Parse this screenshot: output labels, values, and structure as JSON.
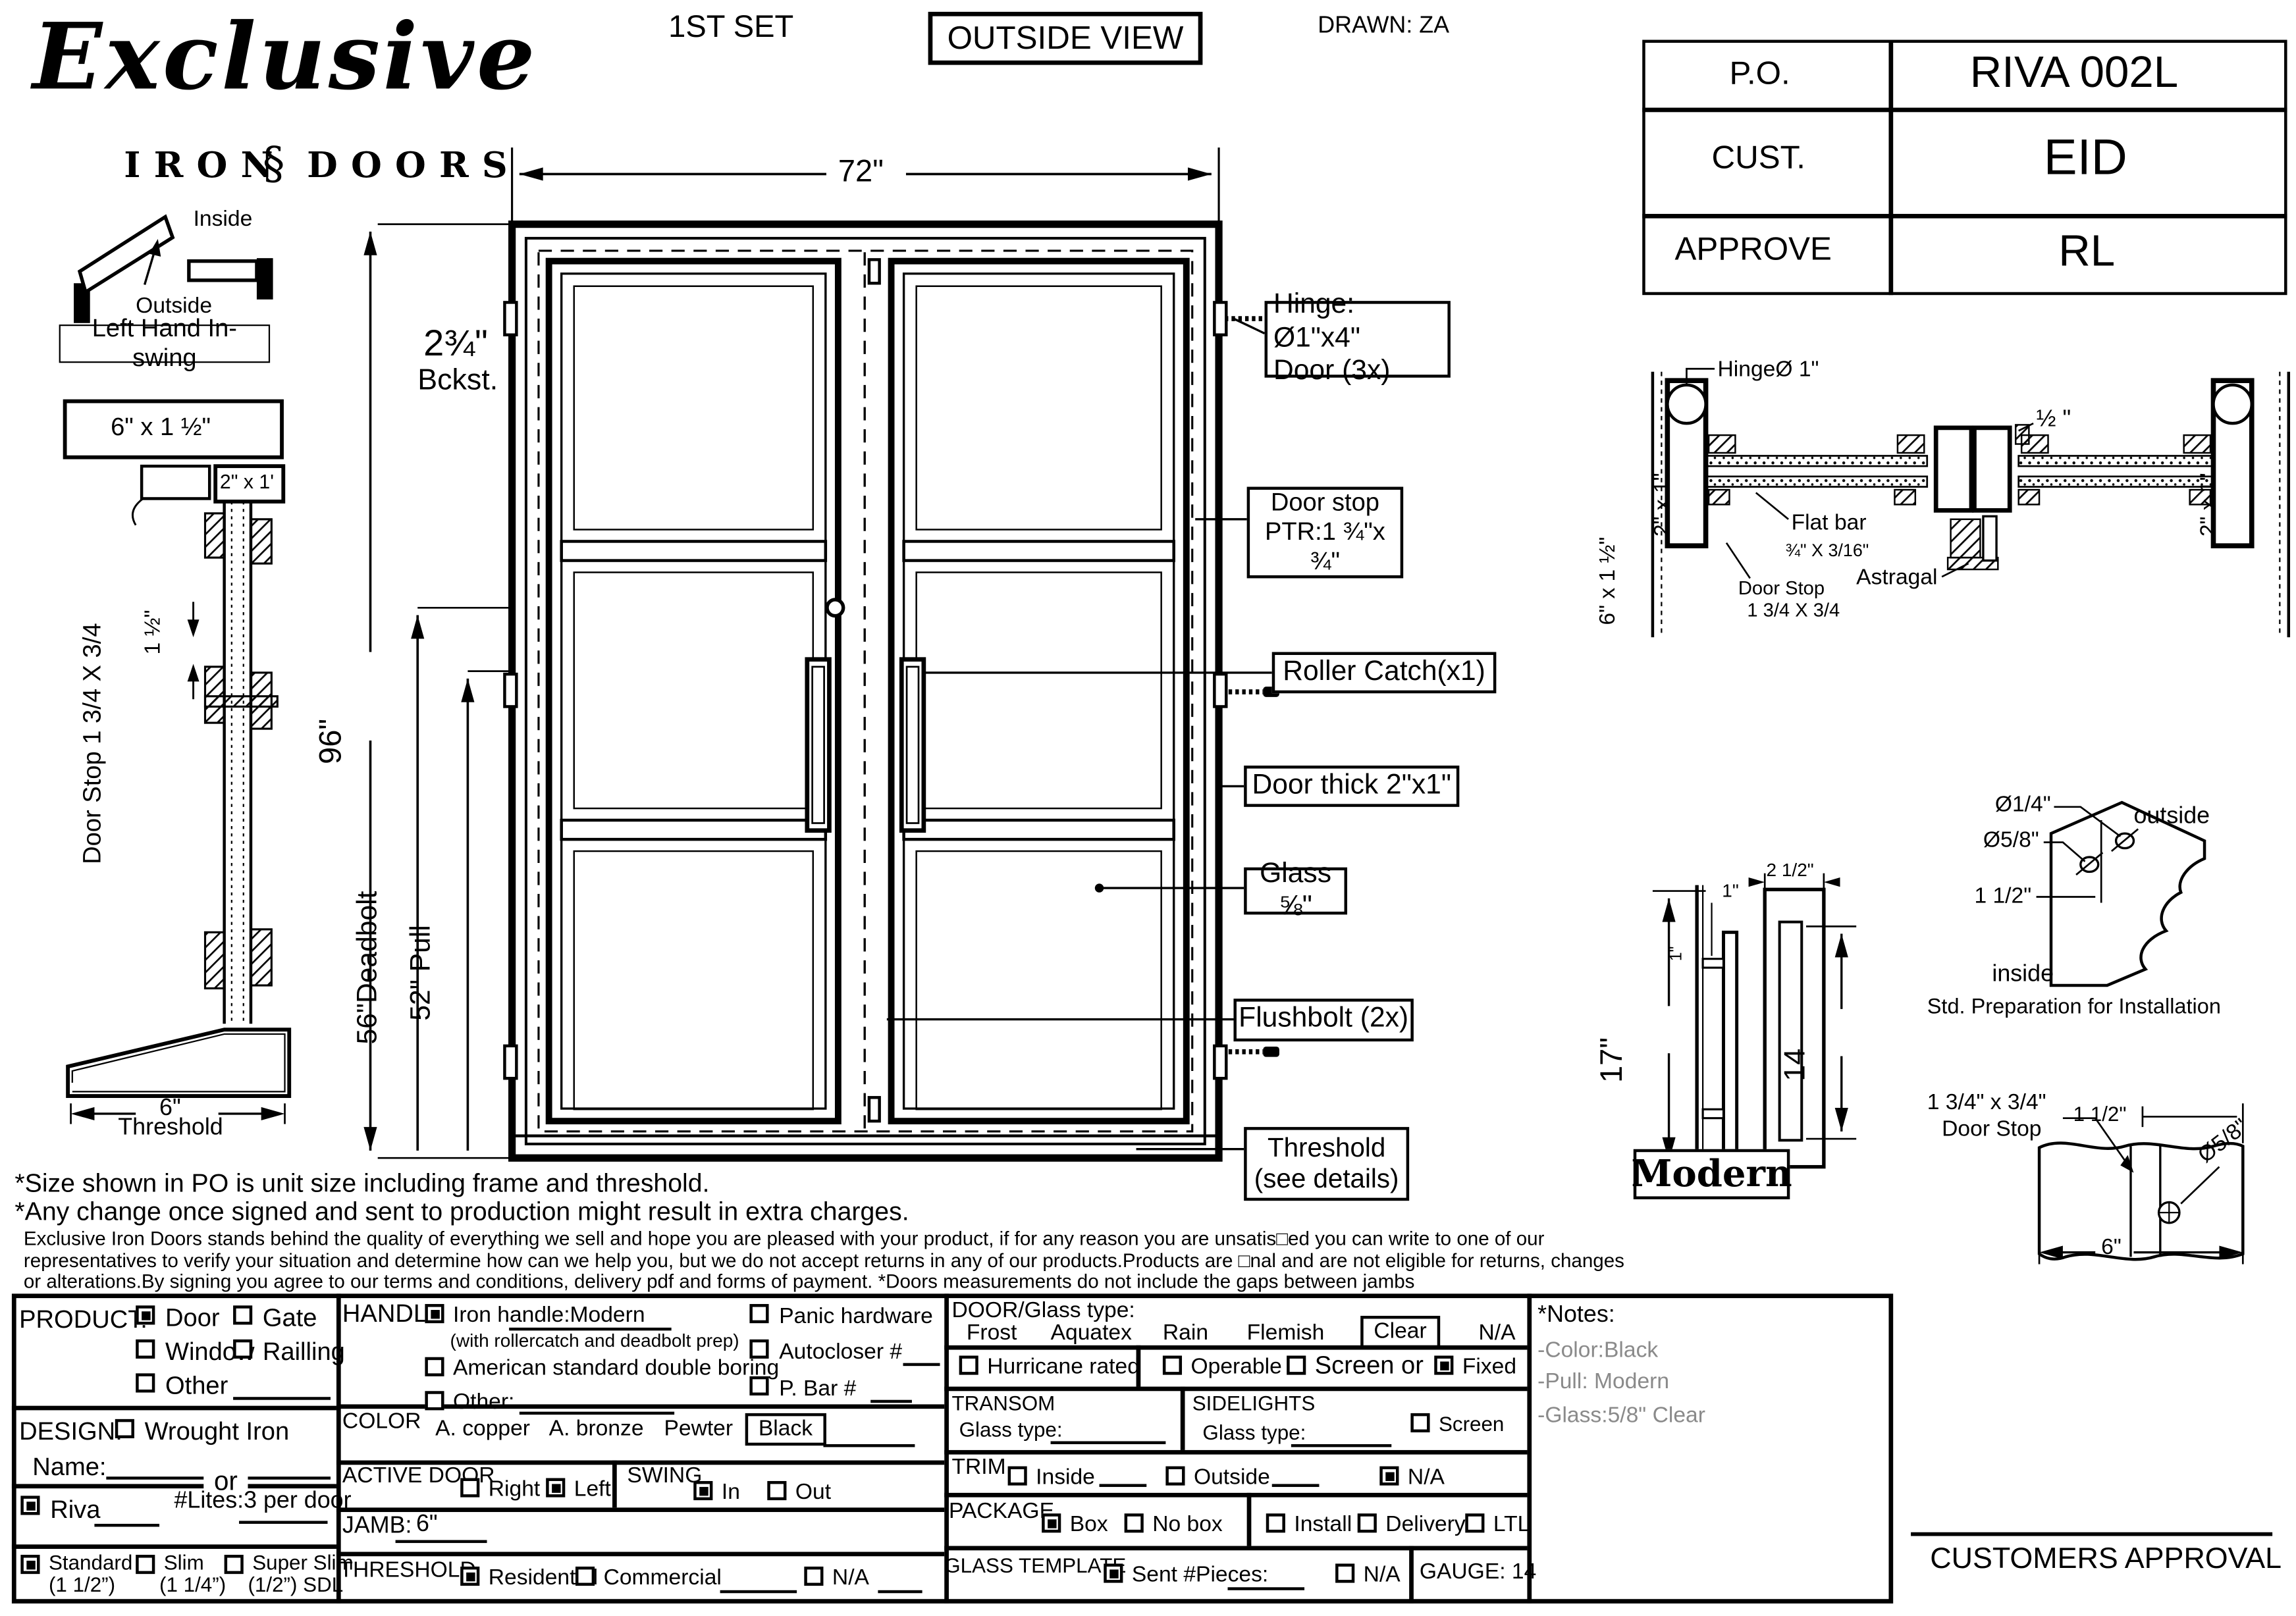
{
  "colors": {
    "ink": "#000000",
    "note_gray": "#8a8a8a"
  },
  "header": {
    "set": "1ST SET",
    "view": "OUTSIDE VIEW",
    "drawn": "DRAWN: ZA"
  },
  "logo": {
    "script": "Exclusive",
    "iron": "IRON",
    "ornament": "§",
    "doors": "DOORS"
  },
  "info_table": {
    "rows": [
      {
        "label": "P.O.",
        "value": "RIVA 002L"
      },
      {
        "label": "CUST.",
        "value": "EID"
      },
      {
        "label": "APPROVE",
        "value": "RL"
      }
    ]
  },
  "swing": {
    "inside": "Inside",
    "outside": "Outside",
    "hand": "Left Hand In-swing"
  },
  "jamb_detail": {
    "head_box": "6\" x 1 ½\"",
    "tube_box": "2\" x 1'",
    "door_stop": "Door Stop 1 3/4 X 3/4",
    "dim": "1 ½\"",
    "thr_dim": "6\"",
    "thr_label": "Threshold"
  },
  "door": {
    "w": "72\"",
    "h": "96\"",
    "deadbolt": "56\"Deadbolt",
    "pull": "52\" Pull",
    "backset_num": "2¾\"",
    "backset_label": "Bckst.",
    "hinge1": "Hinge: Ø1\"x4\"",
    "hinge2": "Door (3x)",
    "stop1": "Door stop",
    "stop2": "PTR:1 ¾\"x ¾\"",
    "roller": "Roller Catch(x1)",
    "thick": "Door thick 2\"x1\"",
    "glass": "Glass ⅝\"",
    "flush": "Flushbolt (2x)",
    "thr1": "Threshold",
    "thr2": "(see details)"
  },
  "head": {
    "hinge": "HingeØ 1\"",
    "half": "½ \"",
    "tube_l": "2\" x 1\"",
    "tube_r": "2\" x 1\"",
    "jamb": "6\" x 1 ½\"",
    "flat1": "Flat bar",
    "flat2": "¾\" X 3/16\"",
    "astragal": "Astragal",
    "stop1": "Door Stop",
    "stop2": "1 3/4 X 3/4"
  },
  "handle": {
    "h": "17\"",
    "one_a": "1\"",
    "one_b": "1\"",
    "w": "2 1/2\"",
    "inner": "14",
    "name": "Modern"
  },
  "prep": {
    "d14": "Ø1/4\"",
    "d58": "Ø5/8\"",
    "d15": "1 1/2\"",
    "outside": "outside",
    "inside": "inside",
    "caption": "Std. Preparation for Installation"
  },
  "stop": {
    "s1": "1 3/4\" x 3/4\"",
    "s2": "Door Stop",
    "d15": "1 1/2\"",
    "d58": "Ø5/8\"",
    "d6": "6\""
  },
  "disclaimer": {
    "l1": "*Size shown in PO is unit size including frame and threshold.",
    "l2": "*Any change once signed and sent to production might result in extra charges.",
    "p1": "Exclusive Iron Doors stands behind the quality of everything we sell and hope you are pleased with your product, if for any reason you are unsatis□ed you can write to one of our",
    "p2": "representatives to verify your situation and determine how can we help you, but we do not accept returns in any of our products.Products are □nal and are not eligible for returns, changes",
    "p3": "or alterations.By signing you agree to our terms and conditions, delivery pdf and forms of payment. *Doors measurements do not include the gaps between jambs"
  },
  "form": {
    "product": {
      "label": "PRODUCT:",
      "door": "Door",
      "gate": "Gate",
      "window": "Window",
      "railing": "Railling",
      "other": "Other",
      "door_checked": true,
      "gate_checked": false,
      "window_checked": false,
      "railing_checked": false,
      "other_checked": false
    },
    "design": {
      "label": "DESIGN:",
      "wrought": "Wrought Iron",
      "wrought_checked": false,
      "name": "Name:",
      "or": "or",
      "riva": "Riva",
      "riva_checked": true,
      "lites": "#Lites:3 per door",
      "std1": "Standard",
      "std2": "(1 1/2”)",
      "std_checked": true,
      "slim1": "Slim",
      "slim2": "(1 1/4”)",
      "slim_checked": false,
      "super1": "Super Slim",
      "super2": "(1/2”) SDL",
      "super_checked": false
    },
    "handle": {
      "label": "HANDLE",
      "iron": "Iron handle:Modern",
      "iron_sub": "(with rollercatch and deadbolt prep)",
      "iron_checked": true,
      "american": "American standard double boring",
      "american_checked": false,
      "other": "Other:",
      "other_checked": false,
      "panic": "Panic hardware",
      "panic_checked": false,
      "autocloser": "Autocloser #",
      "autocloser_checked": false,
      "pbar": "P. Bar #",
      "pbar_checked": false
    },
    "color": {
      "label": "COLOR",
      "copper": "A. copper",
      "bronze": "A. bronze",
      "pewter": "Pewter",
      "black": "Black"
    },
    "active": {
      "label": "ACTIVE DOOR",
      "right": "Right",
      "right_checked": false,
      "left": "Left",
      "left_checked": true
    },
    "swing": {
      "label": "SWING",
      "in": "In",
      "in_checked": true,
      "out": "Out",
      "out_checked": false
    },
    "jamb": {
      "label": "JAMB:",
      "value": "6\""
    },
    "threshold": {
      "label": "THRESHOLD",
      "residential": "Residential",
      "res_checked": true,
      "commercial": "Commercial",
      "com_checked": false,
      "na": "N/A",
      "na_checked": false
    },
    "glass": {
      "label": "DOOR/Glass type:",
      "frost": "Frost",
      "aquatex": "Aquatex",
      "rain": "Rain",
      "flemish": "Flemish",
      "clear": "Clear",
      "na": "N/A"
    },
    "hurricane": {
      "label": "Hurricane rated",
      "checked": false
    },
    "panel": {
      "operable": "Operable",
      "operable_checked": false,
      "screen": "Screen or",
      "screen_checked": false,
      "fixed": "Fixed",
      "fixed_checked": true
    },
    "transom": {
      "label": "TRANSOM",
      "glass": "Glass type:"
    },
    "sidelights": {
      "label": "SIDELIGHTS",
      "glass": "Glass type:",
      "screen": "Screen",
      "screen_checked": false
    },
    "trim": {
      "label": "TRIM",
      "inside": "Inside",
      "inside_checked": false,
      "outside": "Outside",
      "outside_checked": false,
      "na": "N/A",
      "na_checked": true
    },
    "package": {
      "label": "PACKAGE",
      "box": "Box",
      "box_checked": true,
      "nobox": "No box",
      "nobox_checked": false,
      "install": "Install",
      "install_checked": false,
      "delivery": "Delivery",
      "delivery_checked": false,
      "ltl": "LTL",
      "ltl_checked": false
    },
    "template": {
      "label": "GLASS TEMPLATE",
      "sent": "Sent #Pieces:",
      "sent_checked": true,
      "na": "N/A",
      "na_checked": false,
      "gauge": "GAUGE: 14"
    }
  },
  "notes": {
    "title": "*Notes:",
    "items": [
      "-Color:Black",
      "-Pull: Modern",
      "-Glass:5/8\" Clear"
    ]
  },
  "approval": {
    "label": "CUSTOMERS APPROVAL"
  }
}
